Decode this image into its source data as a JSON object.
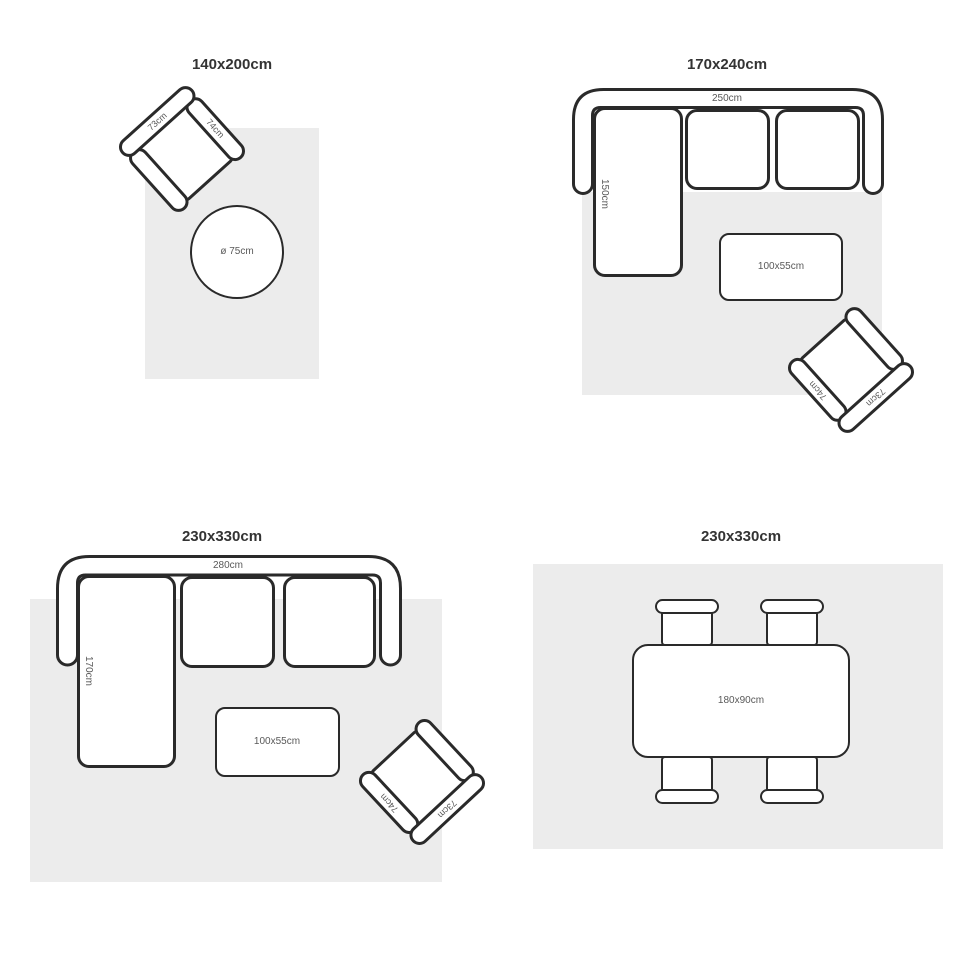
{
  "colors": {
    "outline": "#2a2a2a",
    "rug": "#ececec",
    "label": "#595959",
    "title": "#333333"
  },
  "panels": [
    {
      "title": "140x200cm",
      "armchair": {
        "back_label": "73cm",
        "side_label": "74cm"
      },
      "round_table": {
        "diameter_label": "ø 75cm"
      }
    },
    {
      "title": "170x240cm",
      "sofa": {
        "width_label": "250cm",
        "depth_label": "150cm"
      },
      "coffee_table": {
        "size_label": "100x55cm"
      },
      "armchair": {
        "back_label": "73cm",
        "side_label": "74cm"
      }
    },
    {
      "title": "230x330cm",
      "sofa": {
        "width_label": "280cm",
        "depth_label": "170cm"
      },
      "coffee_table": {
        "size_label": "100x55cm"
      },
      "armchair": {
        "back_label": "73cm",
        "side_label": "74cm"
      }
    },
    {
      "title": "230x330cm",
      "dining_table": {
        "size_label": "180x90cm"
      }
    }
  ]
}
